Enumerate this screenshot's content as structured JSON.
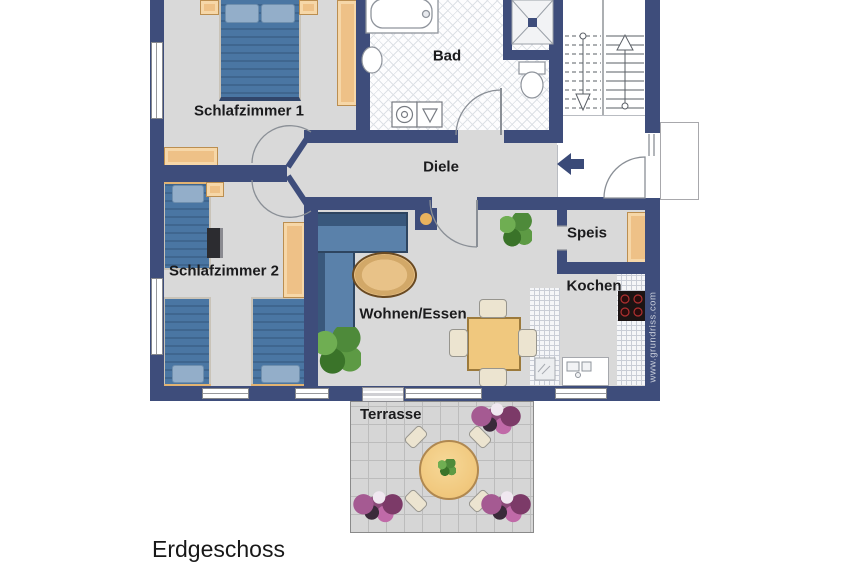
{
  "title": "Erdgeschoss",
  "watermark": "www.grundriss.com",
  "rooms": {
    "schlafzimmer1": "Schlafzimmer 1",
    "schlafzimmer2": "Schlafzimmer 2",
    "bad": "Bad",
    "diele": "Diele",
    "speis": "Speis",
    "kochen": "Kochen",
    "wohnen": "Wohnen/Essen",
    "terrasse": "Terrasse"
  },
  "palette": {
    "wall_navy": "#3e4d7b",
    "floor_gray": "#d9d9d9",
    "furniture_wood": "#eec187",
    "bed_blue": "#4a76a3",
    "sofa_blue": "#5a81aa",
    "table_wood": "#f0c87e",
    "plant_green": "#4e8a3a",
    "flower_purple": "#8a4a78",
    "cooktop_black": "#1c1414",
    "label_text": "#1b1b1d"
  }
}
